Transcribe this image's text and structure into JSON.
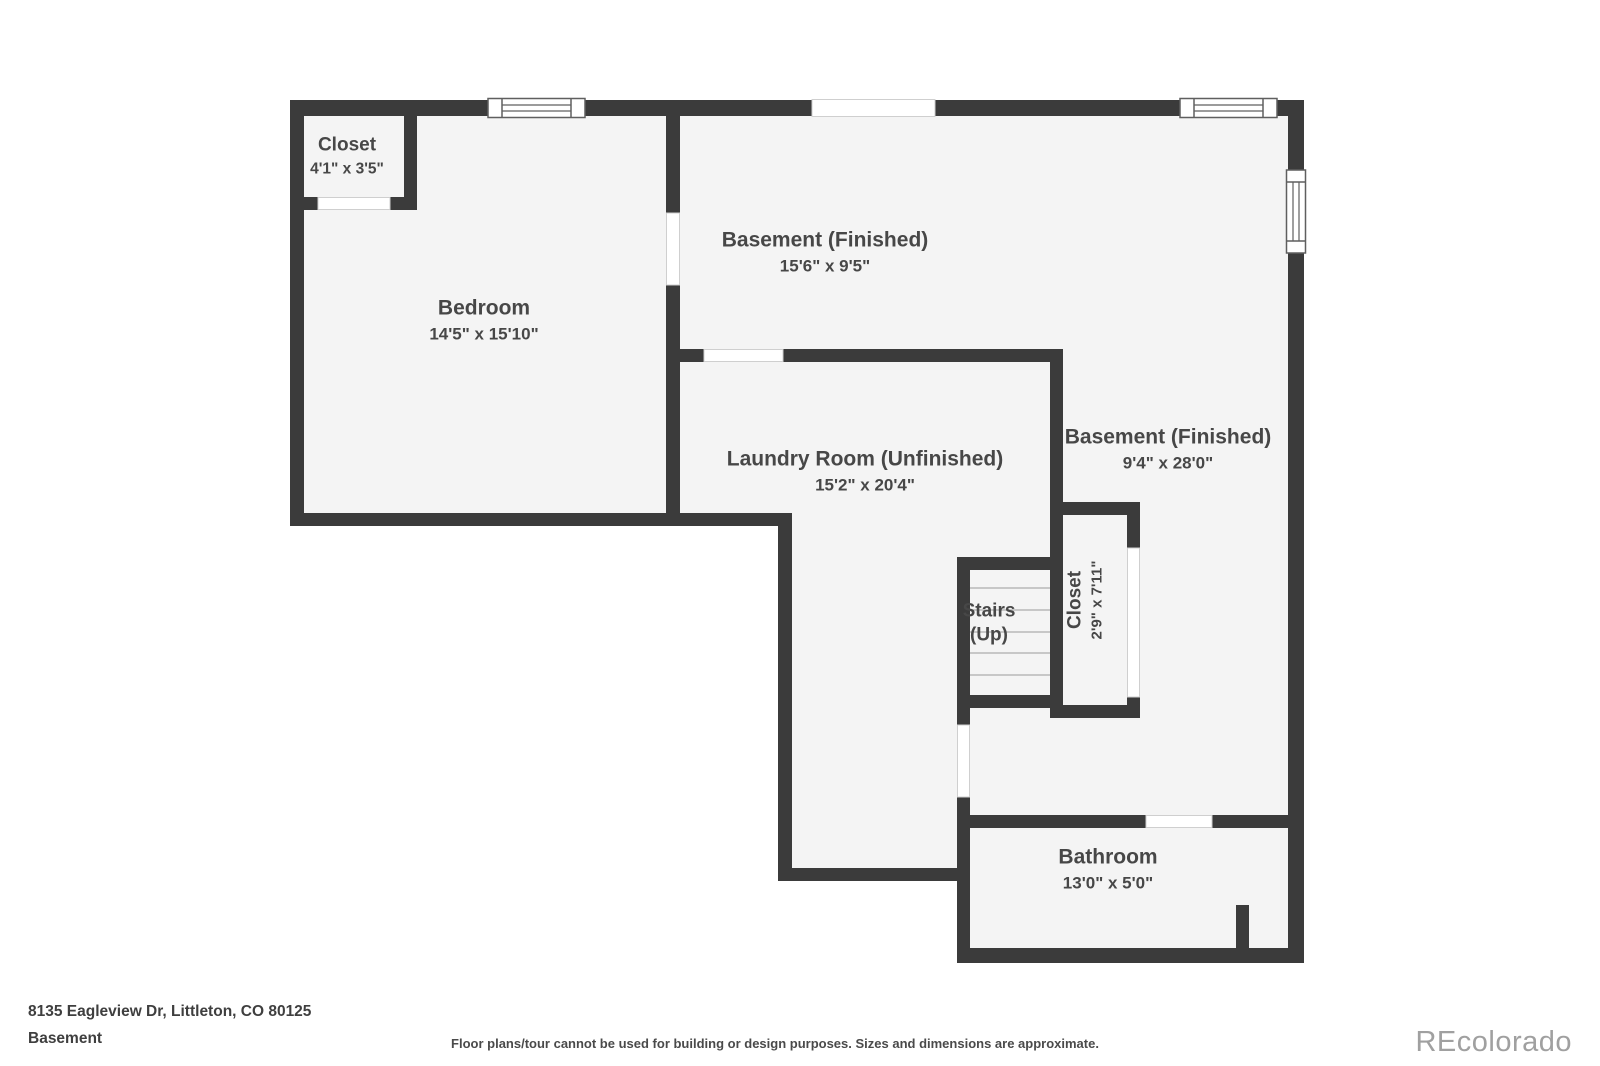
{
  "colors": {
    "wall": "#3b3b3b",
    "floor": "#f4f4f4",
    "label_text": "#474747",
    "footer_text": "#3f3f3f",
    "watermark_text": "#a0a0a0",
    "background": "#ffffff"
  },
  "rooms": [
    {
      "id": "closet-top-left",
      "name": "Closet",
      "dims": "4'1\" x 3'5\""
    },
    {
      "id": "bedroom",
      "name": "Bedroom",
      "dims": "14'5\" x 15'10\""
    },
    {
      "id": "basement-finished-top",
      "name": "Basement (Finished)",
      "dims": "15'6\" x 9'5\""
    },
    {
      "id": "laundry-room",
      "name": "Laundry Room (Unfinished)",
      "dims": "15'2\" x 20'4\""
    },
    {
      "id": "basement-finished-right",
      "name": "Basement (Finished)",
      "dims": "9'4\" x 28'0\""
    },
    {
      "id": "stairs",
      "name": "Stairs",
      "line2": "(Up)"
    },
    {
      "id": "closet-by-stairs",
      "name": "Closet",
      "dims": "2'9\" x 7'11\""
    },
    {
      "id": "bathroom",
      "name": "Bathroom",
      "dims": "13'0\" x 5'0\""
    }
  ],
  "footer": {
    "address": "8135 Eagleview Dr, Littleton, CO 80125",
    "level": "Basement",
    "disclaimer": "Floor plans/tour cannot be used for building or design purposes. Sizes and dimensions are approximate.",
    "watermark": "REcolorado"
  }
}
